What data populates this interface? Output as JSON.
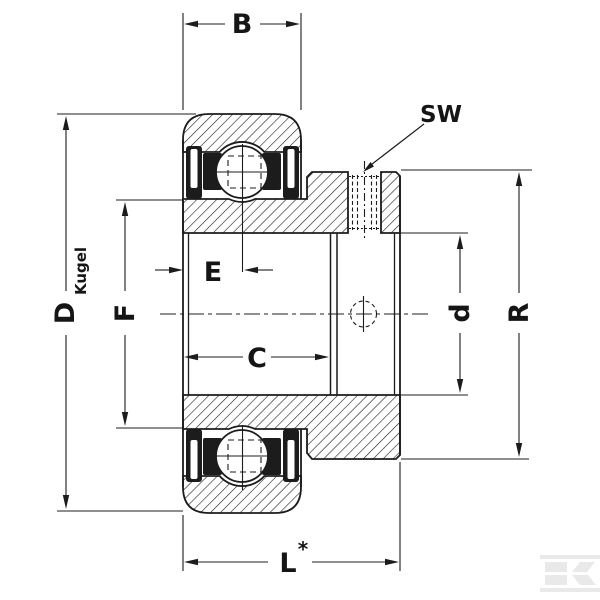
{
  "app": {
    "background": "#ffffff",
    "line_color": "#1c1c1c",
    "logo_color": "#e9e9e9"
  },
  "labels": {
    "b": "B",
    "sw": "SW",
    "d_outer": "D",
    "kugel": "Kugel",
    "f": "F",
    "e": "E",
    "c": "C",
    "d_bore": "d",
    "r": "R",
    "l": "L",
    "l_star": "*"
  }
}
